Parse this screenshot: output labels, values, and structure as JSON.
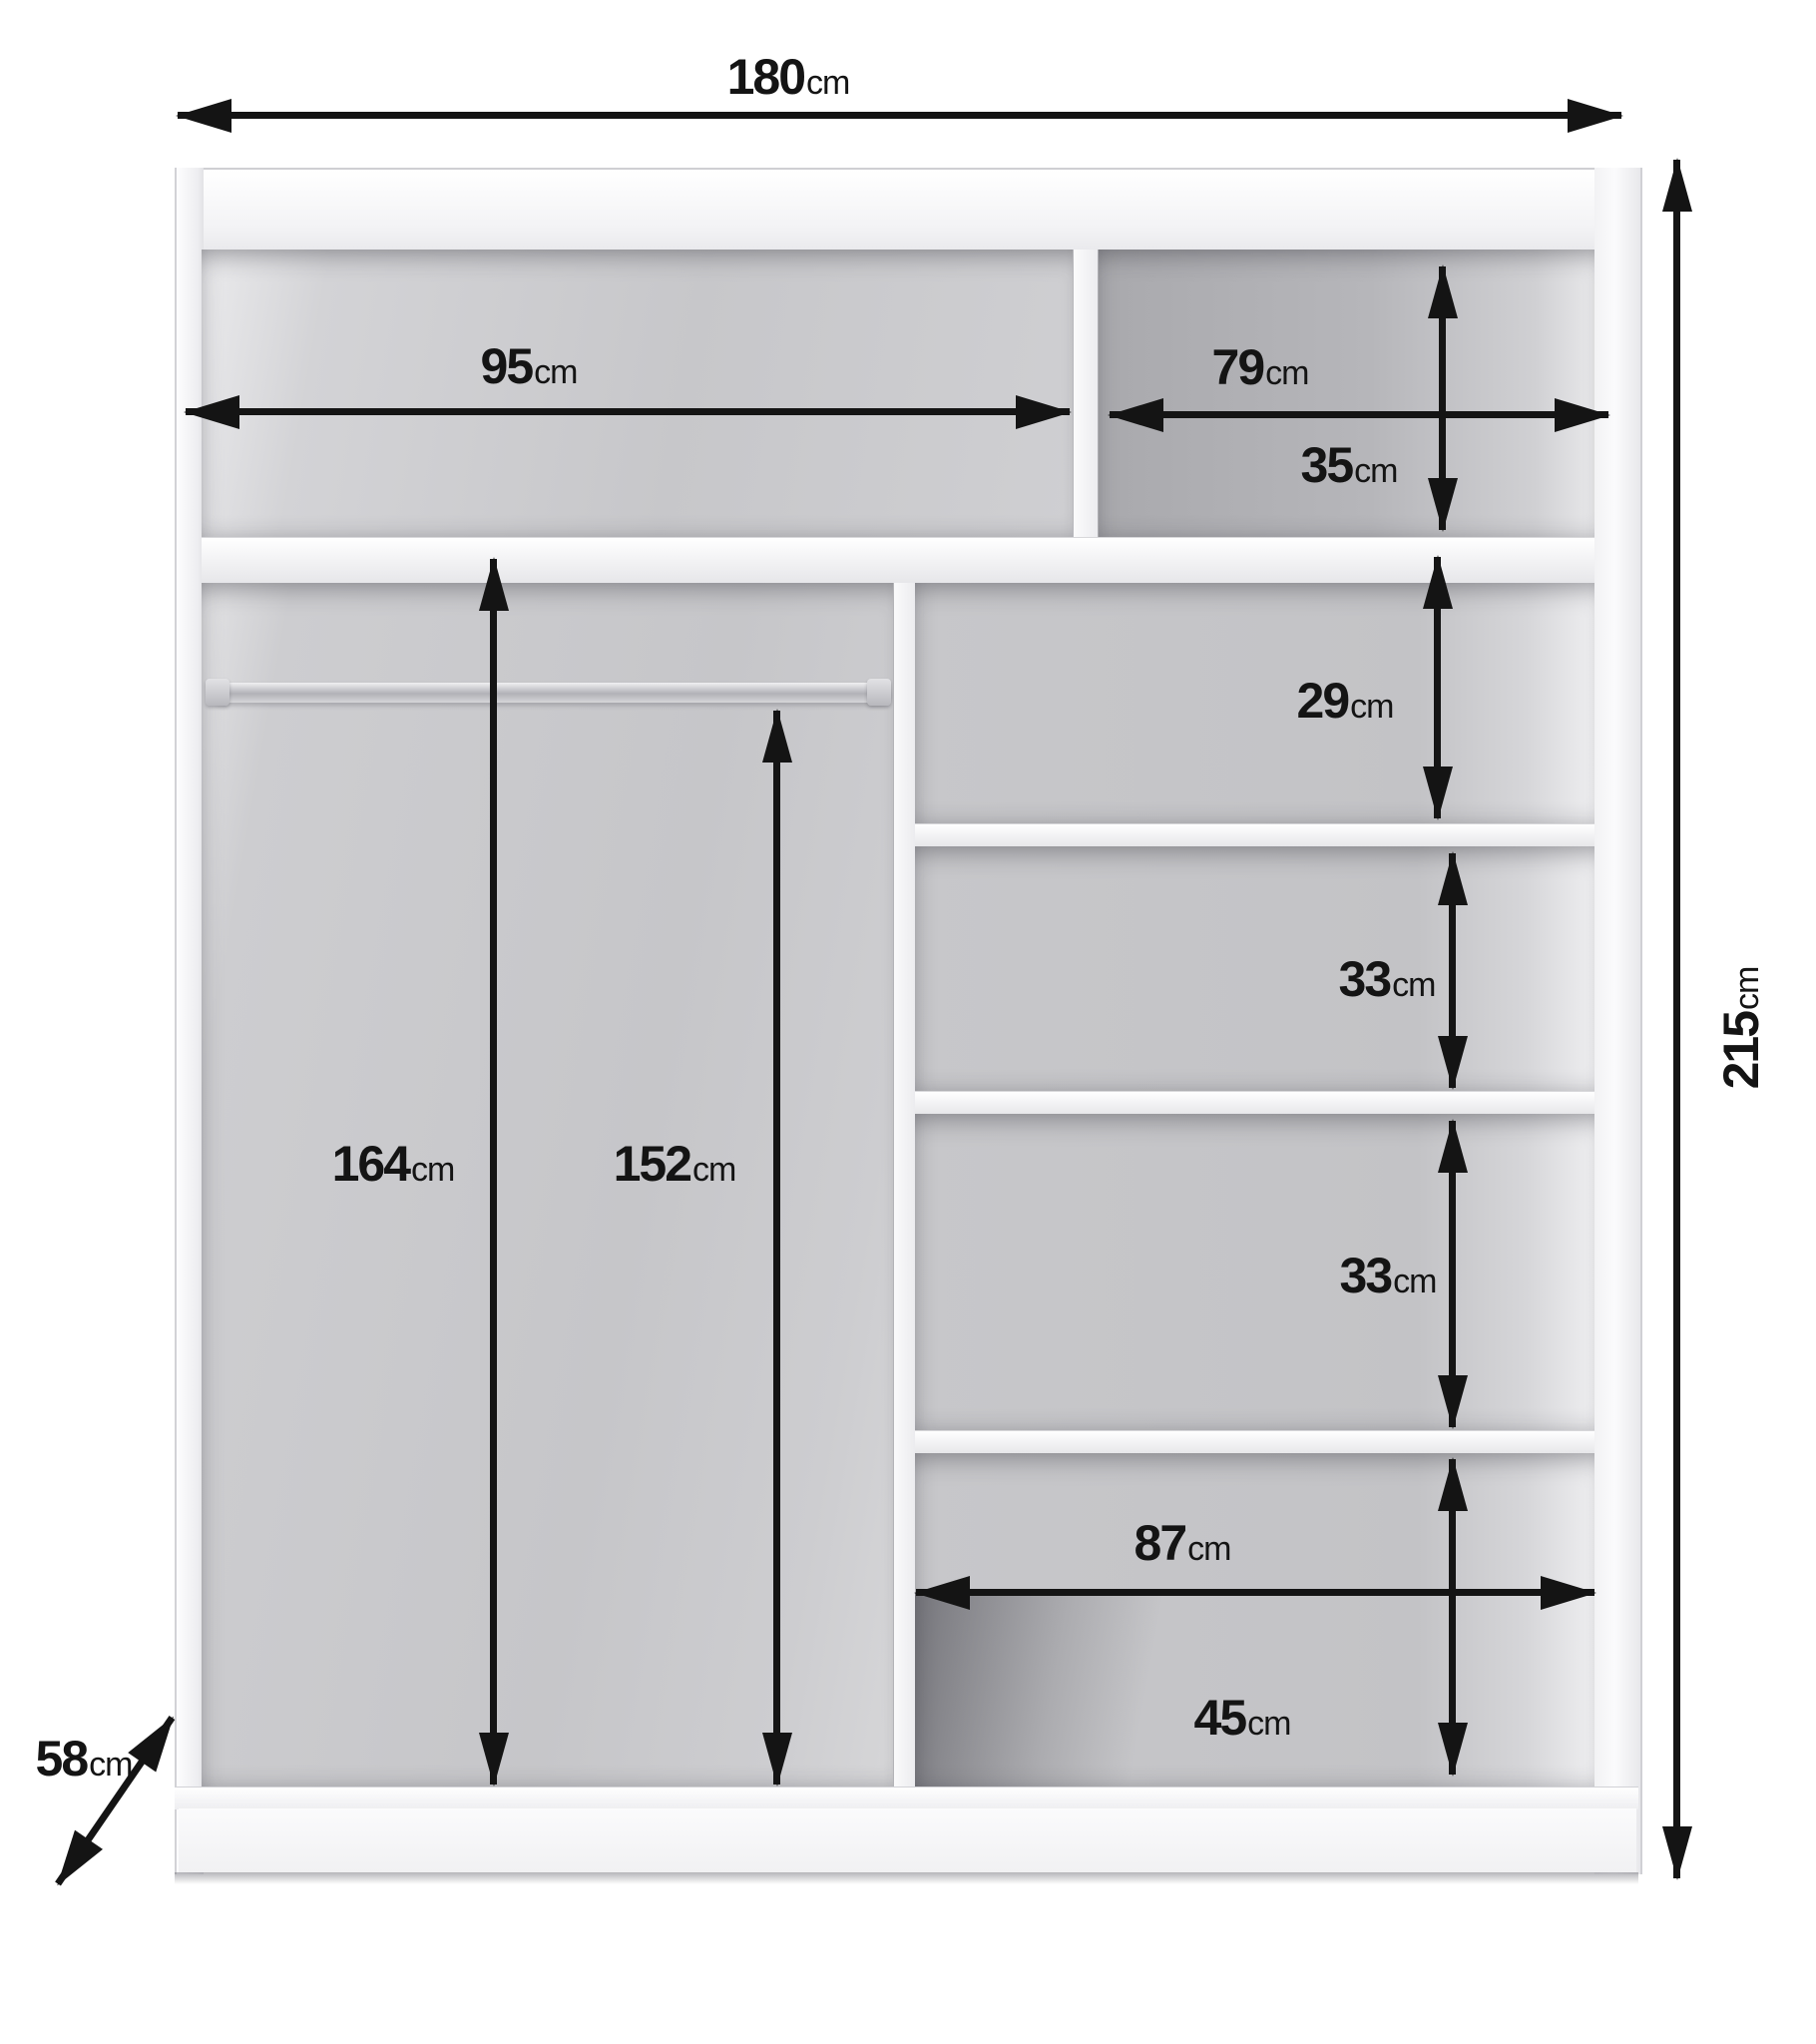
{
  "diagram": {
    "subject": "wardrobe interior dimension diagram",
    "unit": "cm",
    "colors": {
      "background": "#ffffff",
      "furniture_white": "#f5f5f7",
      "interior_gray": "#c6c6c9",
      "interior_dark_gray": "#aaaaae",
      "dimension_black": "#141414"
    },
    "dims": {
      "overall_width": {
        "value": "180",
        "unit": "cm"
      },
      "overall_height": {
        "value": "215",
        "unit": "cm"
      },
      "overall_depth": {
        "value": "58",
        "unit": "cm"
      },
      "top_left_width": {
        "value": "95",
        "unit": "cm"
      },
      "top_right_width": {
        "value": "79",
        "unit": "cm"
      },
      "top_right_height": {
        "value": "35",
        "unit": "cm"
      },
      "shelf_gap_1": {
        "value": "29",
        "unit": "cm"
      },
      "shelf_gap_2": {
        "value": "33",
        "unit": "cm"
      },
      "shelf_gap_3": {
        "value": "33",
        "unit": "cm"
      },
      "bottom_right_width": {
        "value": "87",
        "unit": "cm"
      },
      "bottom_right_height": {
        "value": "45",
        "unit": "cm"
      },
      "hanging_height_left": {
        "value": "164",
        "unit": "cm"
      },
      "hanging_height_right": {
        "value": "152",
        "unit": "cm"
      }
    }
  }
}
